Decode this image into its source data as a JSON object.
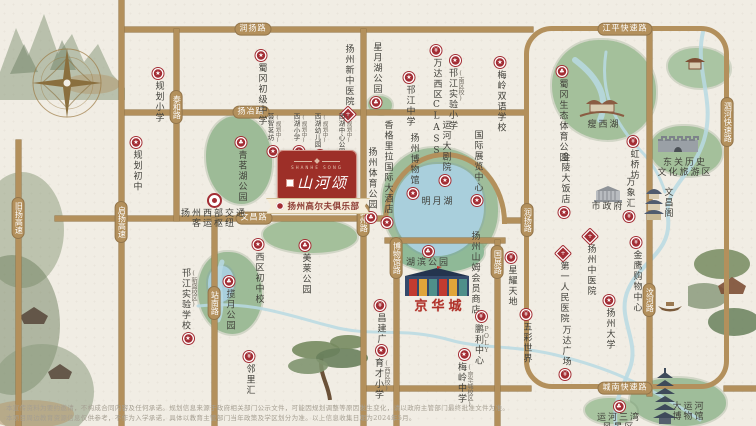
{
  "map": {
    "colors": {
      "road": "#b3905c",
      "badge_red": "#a32d34",
      "park_green": "#9fbd9a",
      "lake_blue": "#a9cfdc",
      "logo_red": "#9d2f28",
      "brand_red": "#b03028"
    },
    "logo": {
      "latin": "SHANHE SONG",
      "project_name": "山河颂",
      "ribbon_label": "扬州高尔夫俱乐部"
    },
    "roads": {
      "segments": [
        {
          "x": 121,
          "y": 27,
          "w": 412,
          "h": 5
        },
        {
          "x": 121,
          "y": 110,
          "w": 406,
          "h": 5
        },
        {
          "x": 55,
          "y": 216,
          "w": 332,
          "h": 5
        },
        {
          "x": 503,
          "y": 218,
          "w": 26,
          "h": 5
        },
        {
          "x": 385,
          "y": 238,
          "w": 120,
          "h": 5
        },
        {
          "x": 363,
          "y": 386,
          "w": 168,
          "h": 5
        },
        {
          "x": 724,
          "y": 386,
          "w": 32,
          "h": 5
        },
        {
          "x": 16,
          "y": 140,
          "w": 5,
          "h": 286
        },
        {
          "x": 119,
          "y": 0,
          "w": 5,
          "h": 426
        },
        {
          "x": 174,
          "y": 29,
          "w": 5,
          "h": 192
        },
        {
          "x": 212,
          "y": 218,
          "w": 5,
          "h": 208
        },
        {
          "x": 361,
          "y": 29,
          "w": 5,
          "h": 397
        },
        {
          "x": 394,
          "y": 240,
          "w": 5,
          "h": 186
        },
        {
          "x": 495,
          "y": 240,
          "w": 5,
          "h": 186
        },
        {
          "x": 647,
          "y": 29,
          "w": 5,
          "h": 367
        }
      ],
      "ring": {
        "x": 524,
        "y": 26,
        "w": 205,
        "h": 363
      },
      "arc": {
        "x": 383,
        "y": 152,
        "w": 124,
        "h": 72
      },
      "labels": [
        {
          "text": "润扬路",
          "x": 253,
          "y": 29,
          "dir": "h"
        },
        {
          "text": "江平快速路",
          "x": 625,
          "y": 29,
          "dir": "h"
        },
        {
          "text": "扬冶路",
          "x": 251,
          "y": 112,
          "dir": "h"
        },
        {
          "text": "文昌路",
          "x": 254,
          "y": 218,
          "dir": "h"
        },
        {
          "text": "城南快速路",
          "x": 625,
          "y": 388,
          "dir": "h"
        },
        {
          "text": "泰和路",
          "x": 176,
          "y": 107,
          "dir": "v"
        },
        {
          "text": "启扬高速",
          "x": 121,
          "y": 222,
          "dir": "v"
        },
        {
          "text": "旧扬高速",
          "x": 18,
          "y": 218,
          "dir": "v"
        },
        {
          "text": "站南路",
          "x": 214,
          "y": 303,
          "dir": "v"
        },
        {
          "text": "真州路",
          "x": 363,
          "y": 220,
          "dir": "v"
        },
        {
          "text": "博物馆路",
          "x": 396,
          "y": 258,
          "dir": "v"
        },
        {
          "text": "国展路",
          "x": 497,
          "y": 262,
          "dir": "v"
        },
        {
          "text": "润扬路",
          "x": 527,
          "y": 220,
          "dir": "v"
        },
        {
          "text": "汶河路",
          "x": 649,
          "y": 300,
          "dir": "v"
        },
        {
          "text": "泗河快速路",
          "x": 727,
          "y": 122,
          "dir": "v"
        }
      ]
    },
    "areas": [
      {
        "x": 206,
        "y": 116,
        "w": 66,
        "h": 88,
        "c": "#9dbb97"
      },
      {
        "x": 552,
        "y": 40,
        "w": 104,
        "h": 100,
        "c": "#a4c09b"
      },
      {
        "x": 668,
        "y": 48,
        "w": 62,
        "h": 40,
        "c": "#aac5a3"
      },
      {
        "x": 650,
        "y": 126,
        "w": 72,
        "h": 50,
        "c": "#a4c09b"
      },
      {
        "x": 382,
        "y": 148,
        "w": 116,
        "h": 118,
        "c": "#9fbd9a"
      },
      {
        "x": 392,
        "y": 230,
        "w": 92,
        "h": 42,
        "c": "#8fb997"
      },
      {
        "x": 198,
        "y": 252,
        "w": 64,
        "h": 82,
        "c": "#9dbb97"
      },
      {
        "x": 263,
        "y": 219,
        "w": 94,
        "h": 34,
        "c": "#a4c09b"
      },
      {
        "x": 630,
        "y": 378,
        "w": 96,
        "h": 48,
        "c": "#9fbd9a"
      },
      {
        "x": 585,
        "y": 398,
        "w": 52,
        "h": 26,
        "c": "#a8c4a0"
      },
      {
        "x": 368,
        "y": 96,
        "w": 24,
        "h": 18,
        "c": "#a4c09b"
      }
    ],
    "lakes": [
      {
        "x": 394,
        "y": 164,
        "w": 90,
        "h": 92
      },
      {
        "x": 208,
        "y": 266,
        "w": 26,
        "h": 36
      }
    ],
    "rivers": [
      {
        "d": "M703,32 C694,70 716,100 704,140 C692,178 664,186 668,218 C672,252 640,262 628,290 C616,318 640,340 630,368 C622,390 612,404 616,426",
        "w": 4
      },
      {
        "d": "M606,52 C600,90 612,120 640,150 C652,162 660,176 665,192",
        "w": 3
      },
      {
        "d": "M198,306 C250,300 290,316 330,326 C372,338 400,326 450,340 C480,349 520,345 560,356 C600,366 640,380 700,420",
        "w": 3
      },
      {
        "d": "M222,262 C214,282 226,300 218,320",
        "w": 5
      },
      {
        "d": "M575,60 C595,75 610,95 600,120",
        "w": 6
      }
    ],
    "pois": [
      {
        "name": "规划小学",
        "x": 158,
        "y": 68,
        "dir": "v",
        "badge": "school",
        "bpos": "top"
      },
      {
        "name": "规划初中",
        "x": 136,
        "y": 137,
        "dir": "v",
        "badge": "school",
        "bpos": "top"
      },
      {
        "name": "蜀冈初级中学",
        "x": 261,
        "y": 50,
        "dir": "v",
        "badge": "school",
        "bpos": "top"
      },
      {
        "name": "扬州新中医院",
        "x": 348,
        "y": 44,
        "dir": "v",
        "badge": "hospital",
        "bpos": "bottom"
      },
      {
        "name": "星月湖公园",
        "x": 376,
        "y": 42,
        "dir": "v",
        "badge": "park",
        "bpos": "bottom"
      },
      {
        "name": "邗江中学",
        "x": 409,
        "y": 72,
        "dir": "v",
        "badge": "school",
        "bpos": "top"
      },
      {
        "name": "万达西区CLASS",
        "x": 436,
        "y": 45,
        "dir": "v",
        "badge": "mall",
        "bpos": "top"
      },
      {
        "name": "邗江实验小学",
        "x": 455,
        "y": 55,
        "dir": "v",
        "badge": "school",
        "bpos": "top",
        "note": "(南区校)"
      },
      {
        "name": "梅岭双语学校",
        "x": 500,
        "y": 57,
        "dir": "v",
        "badge": "school",
        "bpos": "top"
      },
      {
        "name": "蜀冈生态体育公园",
        "x": 562,
        "y": 66,
        "dir": "v",
        "badge": "park",
        "bpos": "top"
      },
      {
        "name": "瘦西湖",
        "x": 604,
        "y": 121,
        "dir": "h",
        "badge": "none"
      },
      {
        "name": "虹桥坊",
        "x": 633,
        "y": 136,
        "dir": "v",
        "badge": "mall",
        "bpos": "top"
      },
      {
        "name": "东关历史文化旅游区",
        "x": 685,
        "y": 159,
        "dir": "h2",
        "lines": [
          "东关历史",
          "文化旅游区"
        ],
        "badge": "none"
      },
      {
        "name": "金陵大饭店",
        "x": 564,
        "y": 152,
        "dir": "v",
        "badge": "hotel",
        "bpos": "bottom"
      },
      {
        "name": "市政府",
        "x": 608,
        "y": 203,
        "dir": "h",
        "badge": "none"
      },
      {
        "name": "万象汇",
        "x": 629,
        "y": 177,
        "dir": "v",
        "badge": "mall",
        "bpos": "bottom"
      },
      {
        "name": "文昌阁",
        "x": 667,
        "y": 187,
        "dir": "v",
        "badge": "none"
      },
      {
        "name": "金鹰购物中心",
        "x": 636,
        "y": 237,
        "dir": "v",
        "badge": "mall",
        "bpos": "top"
      },
      {
        "name": "扬州中医院",
        "x": 590,
        "y": 231,
        "dir": "v",
        "badge": "hospital",
        "bpos": "top"
      },
      {
        "name": "第一人民医院",
        "x": 563,
        "y": 248,
        "dir": "v",
        "badge": "hospital",
        "bpos": "top"
      },
      {
        "name": "扬州大学",
        "x": 609,
        "y": 295,
        "dir": "v",
        "badge": "school",
        "bpos": "top"
      },
      {
        "name": "万达广场",
        "x": 565,
        "y": 325,
        "dir": "v",
        "badge": "mall",
        "bpos": "bottom"
      },
      {
        "name": "运河三湾风景区",
        "x": 619,
        "y": 401,
        "dir": "h2",
        "lines": [
          "运河三湾",
          "风景区"
        ],
        "badge": "park",
        "bpos": "top"
      },
      {
        "name": "大运河博物馆",
        "x": 689,
        "y": 403,
        "dir": "h2",
        "lines": [
          "大运河",
          "博物馆"
        ],
        "badge": "none"
      },
      {
        "name": "青茗湖公园",
        "x": 241,
        "y": 137,
        "dir": "v",
        "badge": "park",
        "bpos": "top"
      },
      {
        "name": "扬州西部交通客运枢纽",
        "x": 214,
        "y": 193,
        "dir": "h2",
        "lines": [
          "扬州西部交通",
          "客运枢纽"
        ],
        "badge": "hub",
        "bpos": "top"
      },
      {
        "name": "香格里拉国际大酒店",
        "x": 387,
        "y": 120,
        "dir": "v",
        "badge": "hotel",
        "bpos": "bottom"
      },
      {
        "name": "扬州体育公园",
        "x": 371,
        "y": 147,
        "dir": "v",
        "badge": "park",
        "bpos": "bottom"
      },
      {
        "name": "扬州博物馆",
        "x": 413,
        "y": 133,
        "dir": "v",
        "badge": "landmark",
        "bpos": "bottom"
      },
      {
        "name": "运河大剧院",
        "x": 445,
        "y": 120,
        "dir": "v",
        "badge": "landmark",
        "bpos": "bottom"
      },
      {
        "name": "国际展览中心",
        "x": 477,
        "y": 130,
        "dir": "v",
        "badge": "landmark",
        "bpos": "bottom"
      },
      {
        "name": "明月湖",
        "x": 438,
        "y": 198,
        "dir": "h",
        "badge": "none"
      },
      {
        "name": "湖滨公园",
        "x": 428,
        "y": 246,
        "dir": "h",
        "badge": "park",
        "bpos": "top"
      },
      {
        "name": "扬州山姆会员商店",
        "x": 474,
        "y": 231,
        "dir": "v",
        "badge": "none"
      },
      {
        "name": "京华城",
        "x": 440,
        "y": 300,
        "dir": "brand",
        "badge": "none"
      },
      {
        "name": "星耀天地",
        "x": 511,
        "y": 252,
        "dir": "v",
        "badge": "mall",
        "bpos": "top"
      },
      {
        "name": "鹏利中心",
        "x": 481,
        "y": 311,
        "dir": "v",
        "badge": "mall",
        "bpos": "top",
        "note": "POLY"
      },
      {
        "name": "五彩世界",
        "x": 526,
        "y": 309,
        "dir": "v",
        "badge": "mall",
        "bpos": "top"
      },
      {
        "name": "梅岭中学",
        "x": 464,
        "y": 349,
        "dir": "v",
        "badge": "school",
        "bpos": "top",
        "note": "(京华城校区)"
      },
      {
        "name": "昌建广场",
        "x": 380,
        "y": 300,
        "dir": "v",
        "badge": "mall",
        "bpos": "top"
      },
      {
        "name": "育才小学",
        "x": 381,
        "y": 345,
        "dir": "v",
        "badge": "school",
        "bpos": "top",
        "note": "(西区校)"
      },
      {
        "name": "美莱公园",
        "x": 305,
        "y": 240,
        "dir": "v",
        "badge": "park",
        "bpos": "top"
      },
      {
        "name": "西区初中校",
        "x": 258,
        "y": 239,
        "dir": "v",
        "badge": "school",
        "bpos": "top"
      },
      {
        "name": "揽月公园",
        "x": 229,
        "y": 276,
        "dir": "v",
        "badge": "park",
        "bpos": "top"
      },
      {
        "name": "邗江实验学校",
        "x": 188,
        "y": 268,
        "dir": "v",
        "badge": "school",
        "bpos": "bottom",
        "note": "(新盛校区)"
      },
      {
        "name": "邻里汇",
        "x": 249,
        "y": 351,
        "dir": "v",
        "badge": "mall",
        "bpos": "top"
      },
      {
        "name": "荟智茗坊",
        "x": 273,
        "y": 113,
        "dir": "v",
        "badge": "school",
        "bpos": "bottom",
        "note": "(规划中)",
        "size": "s"
      },
      {
        "name": "西湖小学",
        "x": 299,
        "y": 113,
        "dir": "v",
        "badge": "school",
        "bpos": "bottom",
        "note": "(规划中)",
        "size": "s"
      },
      {
        "name": "西湖幼儿园",
        "x": 320,
        "y": 113,
        "dir": "v",
        "badge": "school",
        "bpos": "bottom",
        "note": "(规划中)",
        "size": "s"
      },
      {
        "name": "西湖中心公园",
        "x": 344,
        "y": 113,
        "dir": "v",
        "badge": "park",
        "bpos": "bottom",
        "note": "(规划中)",
        "size": "s"
      }
    ],
    "disclaimer": {
      "line1": "本宣传资料为要约邀请，不构成合同内容及任何承诺。规划信息来源于政府相关部门公示文件，可能因规划调整等原因发生变化，请以政府主管部门最终批准文件为准。",
      "line2": "本项目周边教育资源信息仅供参考，不作为入学承诺，具体以教育主管部门当年政策及学区划分为准。以上信息收集日期为2024年5月。"
    }
  }
}
